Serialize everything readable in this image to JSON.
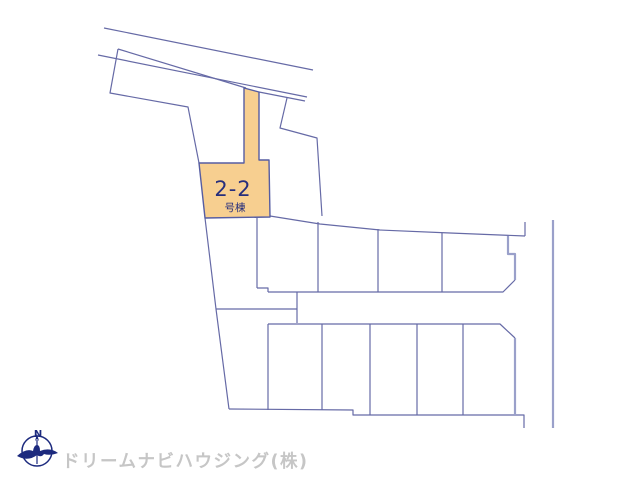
{
  "plan": {
    "title_hint": "housing site layout plan",
    "highlighted_lot": {
      "number": "2-2",
      "suffix": "号棟"
    },
    "middle_row_lot_count": 4,
    "bottom_row_lot_count": 5,
    "colors": {
      "boundary_line": "#666aa6",
      "wide_line": "#9aa0ca",
      "highlight_fill": "#f7cf90",
      "highlight_border": "#565da2",
      "label_text": "#262e7c",
      "compass": "#1c2a7e",
      "watermark_text": "#c6c6c6",
      "background": "#ffffff"
    }
  },
  "compass": {
    "north_label": "N"
  },
  "footer": {
    "company": "ドリームナビハウジング(株)"
  }
}
